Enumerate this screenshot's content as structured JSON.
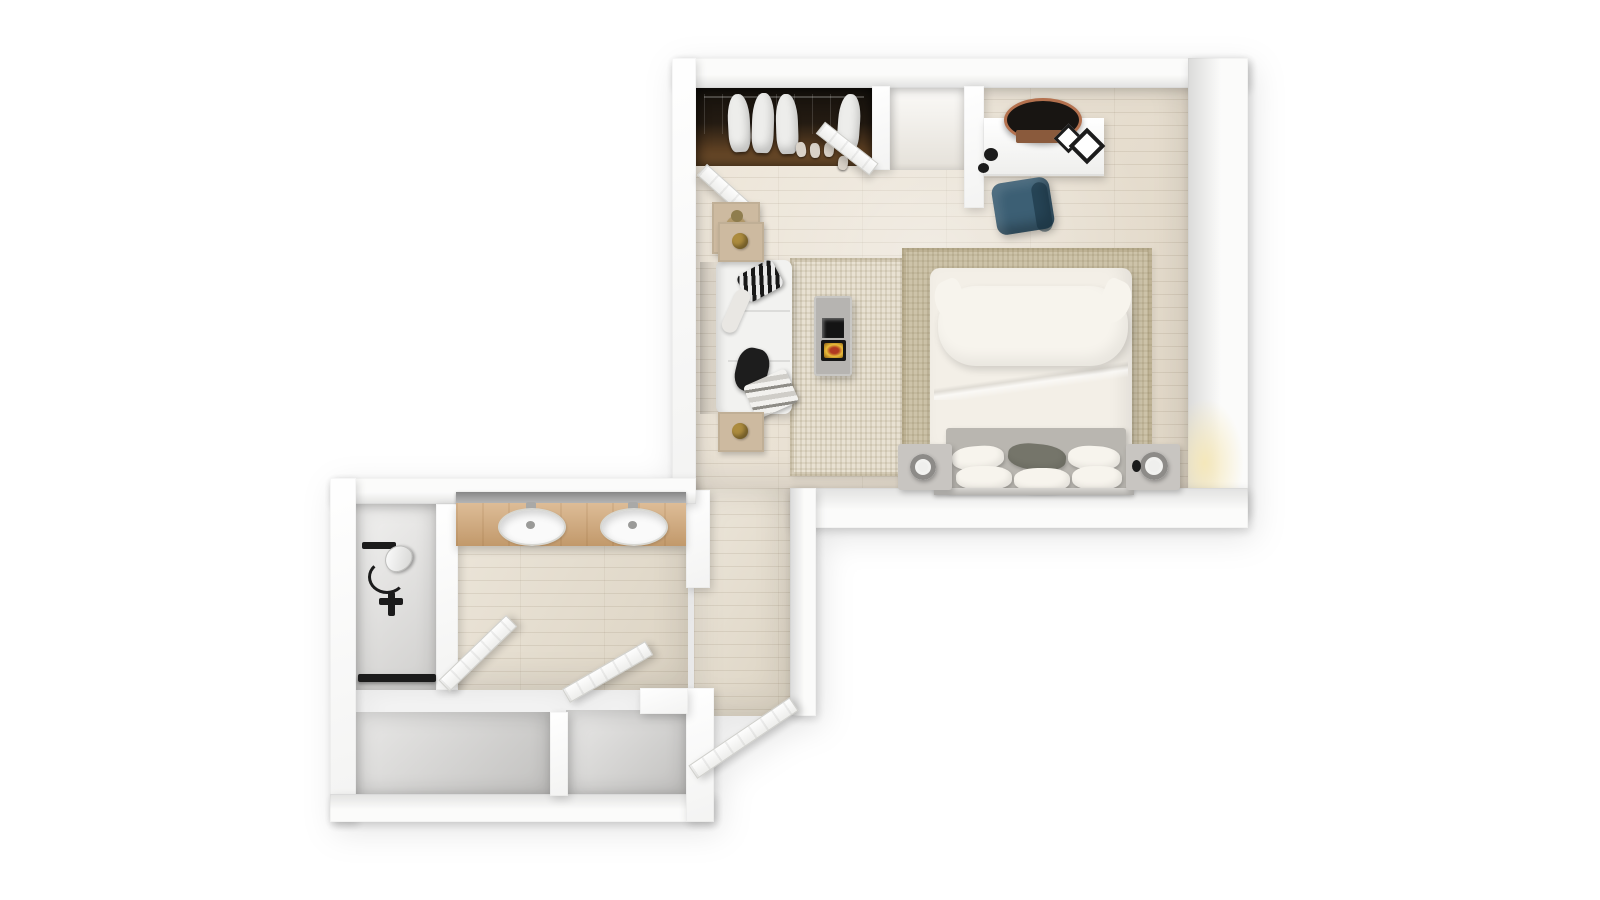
{
  "scene": {
    "type": "3d-floor-plan-top-down-render",
    "rooms": [
      {
        "name": "bedroom",
        "floor": "light-wood-planks"
      },
      {
        "name": "entry-corridor",
        "floor": "light-wood-planks"
      },
      {
        "name": "bathroom-vanity-area",
        "floor": "light-wood-planks"
      },
      {
        "name": "shower-room",
        "floor": "light-gray"
      },
      {
        "name": "storage-room-left",
        "floor": "gray"
      },
      {
        "name": "storage-room-right",
        "floor": "gray"
      },
      {
        "name": "entry-niche",
        "floor": "pale-wood"
      }
    ],
    "furniture": [
      "wardrobe-with-hanging-clothes",
      "wardrobe-door-left",
      "wardrobe-door-right",
      "console-table-with-plant",
      "desk",
      "round-desk-mirror",
      "wall-frames",
      "desk-lamp",
      "blue-desk-chair",
      "sofa",
      "sofa-pillow-patterned",
      "sofa-pillow-dark",
      "sofa-throw-striped",
      "side-table-top",
      "side-table-bottom",
      "fireplace-stove",
      "lounge-rug",
      "bed-rug",
      "double-bed",
      "large-pillow",
      "duvet",
      "headboard",
      "small-pillows-x6",
      "nightstand-left",
      "nightstand-right",
      "table-lamp-left",
      "table-lamp-right",
      "wall-sconce-glow",
      "vanity-counter",
      "vanity-mirror",
      "sink-left",
      "sink-right",
      "shower-head",
      "shower-handle",
      "shower-threshold",
      "shower-door",
      "storage-door",
      "entry-door"
    ],
    "counts": {
      "sinks": 2,
      "doors": 5,
      "nightstands": 2,
      "garments": 4,
      "small_pillows": 6
    }
  },
  "palette": {
    "background": "#ffffff",
    "wall": "#fbfbfa",
    "wood_floor": "#e9dfce",
    "wood_floor_hall": "#e5dccb",
    "niche_floor": "#f1ede5",
    "gray_floor": "#d7d6d4",
    "shower_floor": "#e7e6e4",
    "rug_bed": "#cdc3a9",
    "rug_lounge": "#e8e1d2",
    "closet_dark": "#1f1810",
    "closet_wood": "#6e4b28",
    "garment_white": "#ededeb",
    "shoe_white": "#d9d2c8",
    "vanity_wood": "#d2a674",
    "mirror_gray": "#8f8f8f",
    "sink_white": "#fafafa",
    "bedding_white": "#f7f4ed",
    "duvet_white": "#f3efe7",
    "pillow_gray": "#75756a",
    "headboard_gray": "#b9b6b0",
    "nightstand_gray": "#c8c5c1",
    "sofa_white": "#f2f2f0",
    "side_table_wood": "#cdbaa0",
    "brass": "#ad8c3e",
    "chair_blue": "#3c5f74",
    "stove_gray": "#b6b4b1",
    "picture_black": "#141414",
    "fire_glow": "#e8bc3a",
    "fire_ember": "#b13a22",
    "fixture_black": "#1b1b1b",
    "door_white": "#f7f7f5",
    "plant_pot": "#b39a6a",
    "plant_green": "#8f7d4e",
    "sconce_glow": "#f5e7b8"
  }
}
